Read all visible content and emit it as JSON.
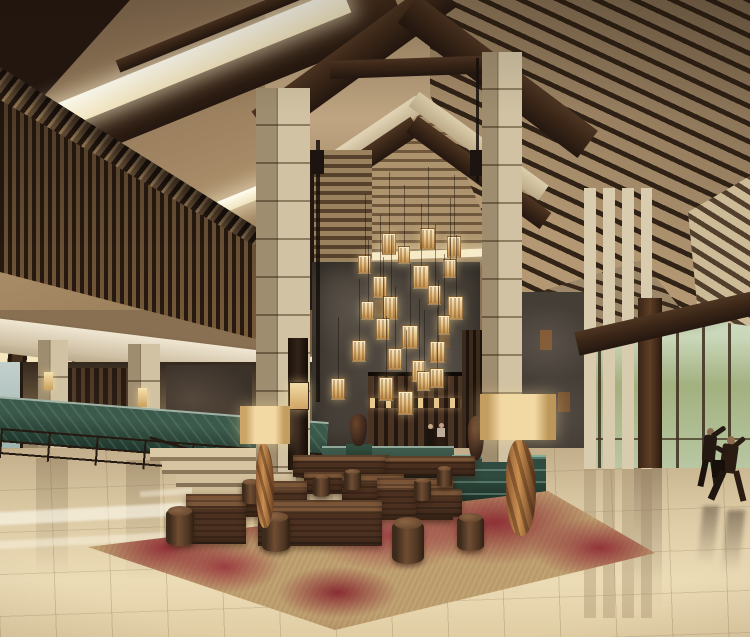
{
  "scene": {
    "title": "Luxury hotel lobby — architectural rendering",
    "description": "3D rendering of a grand Asian resort hotel lobby: vaulted timber roof with dark rafters and linear skylights, stone-clad columns, a cluster of warm lantern pendant lights over a dark stone feature wall, green marble reception counters, a left mezzanine colonnade with cove lighting, a right glass curtain wall with daylight and trees, polished beige travertine floor with reflections, and a red-and-tan rug with walnut block benches, drum stools and floor lamps. Four figures: two guests at reception, two people walking by the windows.",
    "setting": "hotel lobby interior",
    "people_count": 4,
    "lantern_pendant_count": 24,
    "furniture": [
      "walnut block benches",
      "wood drum stools",
      "drum-shade floor lamps",
      "green marble counters",
      "amphora vases"
    ],
    "architecture": [
      "timber gable roof",
      "linear skylights",
      "slatted wood screens",
      "stone columns",
      "glass curtain wall",
      "stone feature wall",
      "stairs with metal railing"
    ]
  },
  "palette": {
    "wood_dark": "#3a2617",
    "ceiling_tan": "#b9a183",
    "skylight": "#fbf7e8",
    "stone_column": "#cfc2a2",
    "stone_wall": "#4e463e",
    "marble_green": "#2c4639",
    "floor_beige": "#d5c29c",
    "rug_red": "#8e3036",
    "rug_tan": "#bb9c6e",
    "walnut": "#5a3b26",
    "glass_daylight": "#e9f1e9",
    "lantern_glow": "#e9c98e"
  }
}
